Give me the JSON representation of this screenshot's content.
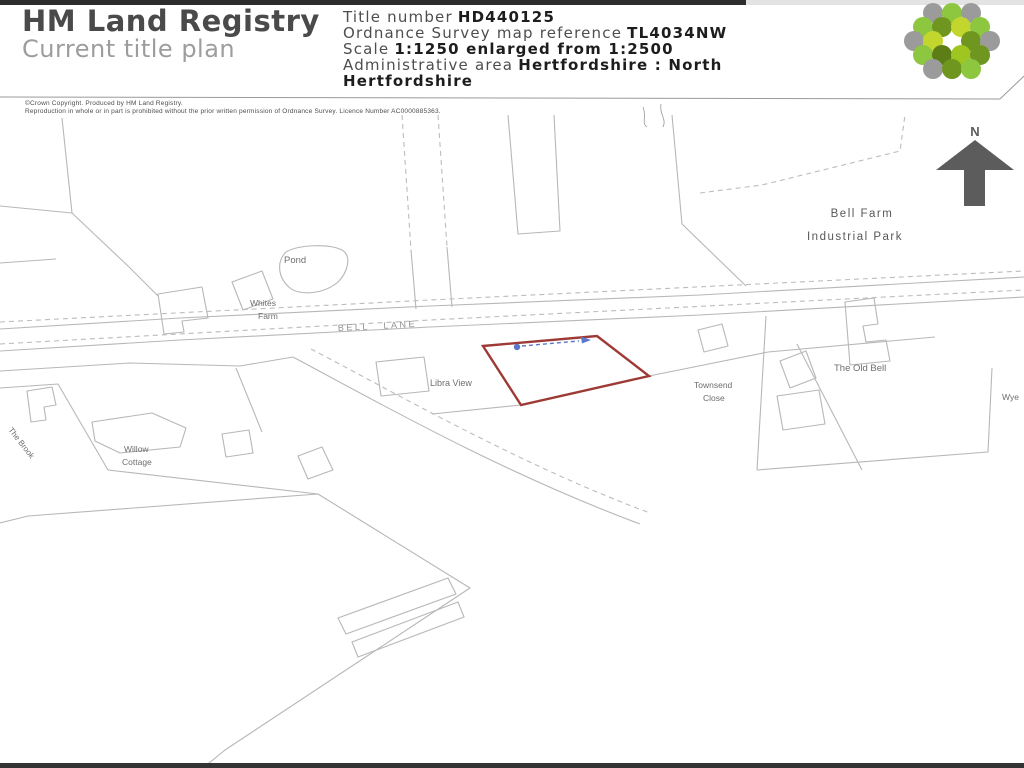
{
  "page": {
    "title": "HM Land Registry — Current title plan"
  },
  "header": {
    "brand_line1": "HM Land Registry",
    "brand_line2": "Current title plan",
    "info": {
      "title_number_label": "Title number",
      "title_number_value": "HD440125",
      "os_ref_label": "Ordnance Survey map reference",
      "os_ref_value": "TL4034NW",
      "scale_label": "Scale",
      "scale_value": "1:1250 enlarged from 1:2500",
      "admin_label": "Administrative area",
      "admin_value_line1": "Hertfordshire : North",
      "admin_value_line2": "Hertfordshire"
    }
  },
  "copyright": {
    "line1": "©Crown Copyright. Produced by HM Land Registry.",
    "line2": "Reproduction in whole or in part is prohibited without the prior written permission of Ordnance Survey. Licence Number AC0000885363."
  },
  "map": {
    "north_indicator": "N",
    "labels": {
      "pond": "Pond",
      "whites_farm_1": "Whites",
      "whites_farm_2": "Farm",
      "bell_lane": "BELL LANE",
      "bell_farm_1": "Bell Farm",
      "bell_farm_2": "Industrial Park",
      "libra_view": "Libra View",
      "townsend_1": "Townsend",
      "townsend_2": "Close",
      "the_old_bell": "The Old Bell",
      "willow_cottage_1": "Willow",
      "willow_cottage_2": "Cottage",
      "the_brook": "The Brook",
      "right_edge_partial": "Wye"
    },
    "colors": {
      "map_line": "#b7b7b7",
      "parcel_outline_red": "#9e3a36",
      "annotation_blue": "#5b78c8",
      "north_arrow_gray": "#5c5c5c",
      "label_gray": "#6e6e6e"
    }
  },
  "logo": {
    "name": "hm-land-registry-hexagon-logo",
    "colors": [
      "#8dc63f",
      "#6f961f",
      "#5d7d17",
      "#c3d62e",
      "#9b9b9b"
    ]
  }
}
